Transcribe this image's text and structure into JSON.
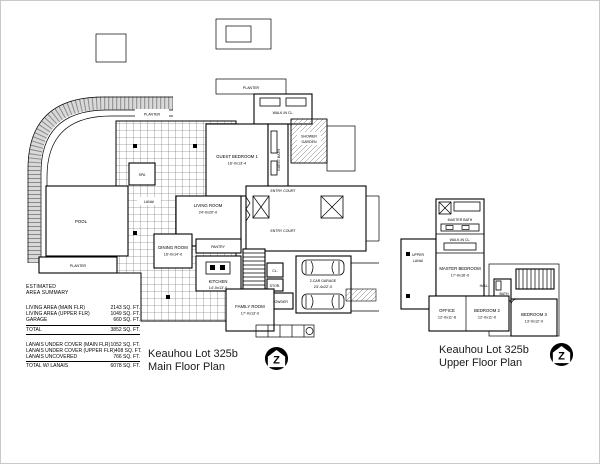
{
  "page": {
    "background": "#ffffff",
    "border_color": "#c9c9c9"
  },
  "summary": {
    "heading_line1": "ESTIMATED",
    "heading_line2": "AREA SUMMARY",
    "rows": [
      {
        "label": "LIVING AREA (MAIN FLR)",
        "value": "2143 SQ. FT."
      },
      {
        "label": "LIVING AREA (UPPER FLR)",
        "value": "1049 SQ. FT."
      },
      {
        "label": "GARAGE",
        "value": "660 SQ. FT."
      },
      {
        "label": "TOTAL",
        "value": "3852 SQ. FT."
      },
      {
        "label": "LANAIS UNDER COVER (MAIN FLR)",
        "value": "1052 SQ. FT."
      },
      {
        "label": "LANAIS UNDER COVER (UPPER FLR)",
        "value": "408 SQ. FT."
      },
      {
        "label": "LANAIS UNCOVERED",
        "value": "766 SQ. FT."
      },
      {
        "label": "TOTAL W/ LANAIS",
        "value": "6078 SQ. FT."
      }
    ]
  },
  "main_plan": {
    "title_line1": "Keauhou Lot 325b",
    "title_line2": "Main Floor Plan",
    "labels": {
      "planter_top_left": "PLANTER",
      "planter_top_center": "PLANTER",
      "planter_bottom": "PLANTER",
      "pool": "POOL",
      "spa": "SPA",
      "lanai": "LANAI",
      "walk_in_closet": "WALK-IN CL.",
      "guest_bedroom": {
        "name": "GUEST BEDROOM 1",
        "dims": "16'-0x13'-4"
      },
      "guest_bath": "GUEST BATH",
      "shower_garden_line1": "SHOWER",
      "shower_garden_line2": "GARDEN",
      "entry_court_upper": "ENTRY COURT",
      "entry_court_lower": "ENTRY COURT",
      "living_room": {
        "name": "LIVING ROOM",
        "dims": "24'-0x20'-0"
      },
      "dining_room": {
        "name": "DINING ROOM",
        "dims": "16'-0x14'-0"
      },
      "pantry": "PANTRY",
      "kitchen": {
        "name": "KITCHEN",
        "dims": "14'-0x13'-0"
      },
      "family_room": {
        "name": "FAMILY ROOM",
        "dims": "17'-0x13'-0"
      },
      "garage": {
        "name": "2-CAR GARAGE",
        "dims": "23'-4x22'-0"
      },
      "closet": "CL.",
      "storage": "STOR.",
      "powder": "POWDER"
    }
  },
  "upper_plan": {
    "title_line1": "Keauhou Lot 325b",
    "title_line2": "Upper Floor Plan",
    "labels": {
      "upper_lanai_line1": "UPPER",
      "upper_lanai_line2": "LANAI",
      "master_bath": "MASTER BATH",
      "walk_in_closet": "WALK-IN CL.",
      "master_bedroom": {
        "name": "MASTER BEDROOM",
        "dims": "17'-0x16'-0"
      },
      "office": {
        "name": "OFFICE",
        "dims": "12'-0x11'-6"
      },
      "bedroom2": {
        "name": "BEDROOM 2",
        "dims": "12'-0x11'-0"
      },
      "bedroom3": {
        "name": "BEDROOM 3",
        "dims": "13'-0x12'-0"
      },
      "hall": "HALL",
      "bath": "BATH"
    }
  },
  "north_logo": {
    "letter": "Z"
  }
}
